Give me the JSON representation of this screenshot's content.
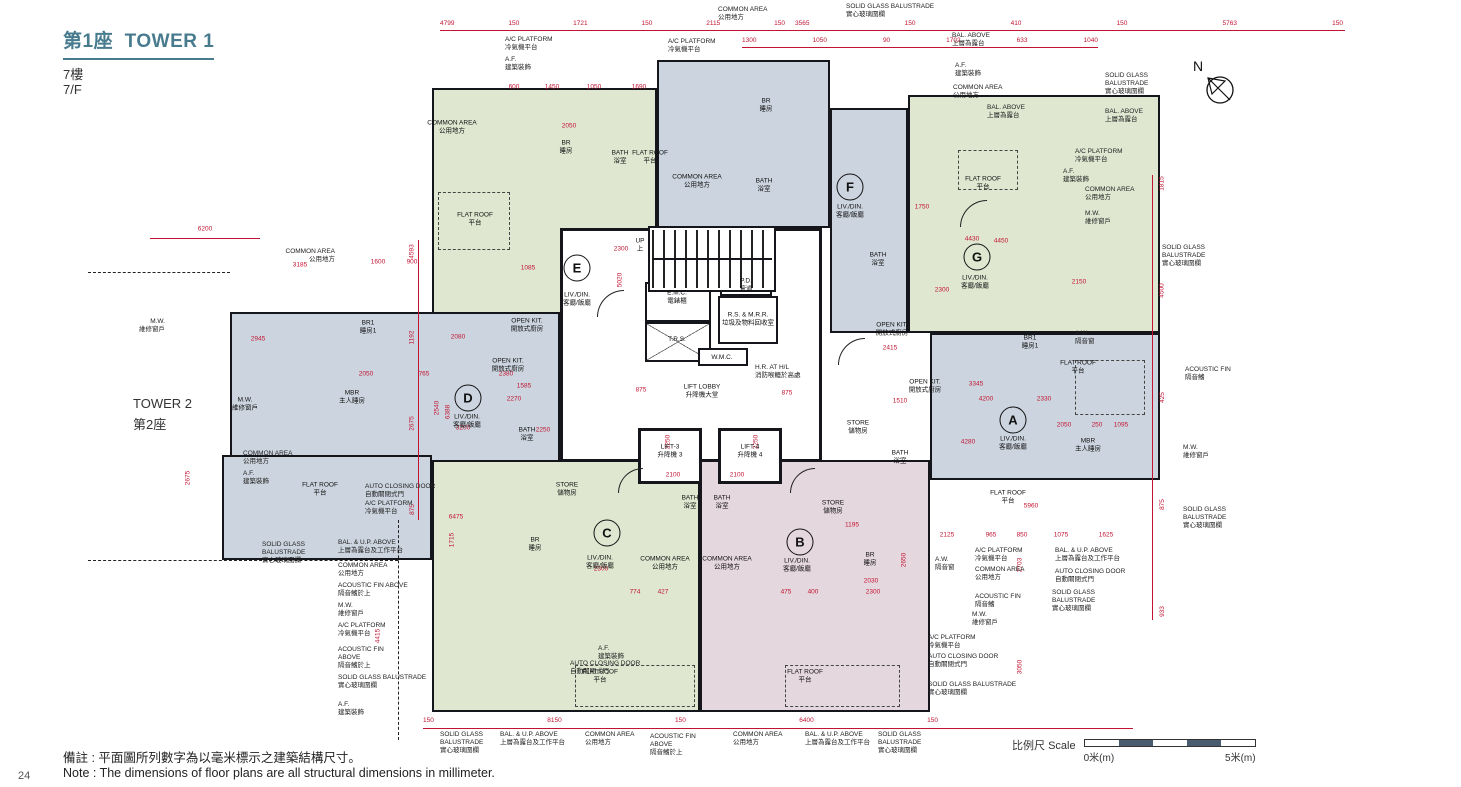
{
  "header": {
    "title_zh": "第1座",
    "title_en": "TOWER 1",
    "floor_zh": "7樓",
    "floor_en": "7/F"
  },
  "tower2": {
    "en": "TOWER 2",
    "zh": "第2座"
  },
  "compass": {
    "label": "N"
  },
  "page": {
    "number": "24"
  },
  "scale": {
    "zh": "比例尺",
    "en": "Scale",
    "from": "0米(m)",
    "to": "5米(m)"
  },
  "notes": {
    "zh": "備註 : 平面圖所列數字為以毫米標示之建築結構尺寸。",
    "en": "Note : The dimensions of floor plans are all structural dimensions in millimeter."
  },
  "units": [
    "A",
    "B",
    "C",
    "D",
    "E",
    "F",
    "G"
  ],
  "colors": {
    "dim_red": "#c21432",
    "zone_green": "#dfe7d1",
    "zone_blue": "#ccd5df",
    "zone_pink": "#e5d7de",
    "title_teal": "#477b8d",
    "scale_dark": "#4a5c70"
  },
  "labels": {
    "sgb": {
      "en": "SOLID GLASS BALUSTRADE",
      "zh": "實心玻璃圍欄"
    },
    "sgb2": {
      "en": "SOLID GLASS",
      "en2": "BALUSTRADE",
      "zh": "實心玻璃圍欄"
    },
    "balup": {
      "en": "BAL. & U.P. ABOVE",
      "zh": "上層為露台及工作平台"
    },
    "bal": {
      "en": "BAL. ABOVE",
      "zh": "上層為露台"
    },
    "ca": {
      "en": "COMMON AREA",
      "zh": "公用地方"
    },
    "afina": {
      "en": "ACOUSTIC FIN ABOVE",
      "zh": "隔音鰭於上"
    },
    "afin": {
      "en": "ACOUSTIC FIN",
      "zh": "隔音鰭"
    },
    "mw": {
      "en": "M.W.",
      "zh": "維修窗戶"
    },
    "aw": {
      "en": "A.W.",
      "zh": "隔音窗"
    },
    "acp": {
      "en": "A/C PLATFORM",
      "zh": "冷氣機平台"
    },
    "acd": {
      "en": "AUTO CLOSING DOOR",
      "zh": "自動關閉式門"
    },
    "af": {
      "en": "A.F.",
      "zh": "建築裝飾"
    },
    "fr": {
      "en": "FLAT ROOF",
      "zh": "平台"
    },
    "ok": {
      "en": "OPEN KIT.",
      "zh": "開放式廚房"
    },
    "bath": {
      "en": "BATH",
      "zh": "浴室"
    },
    "store": {
      "en": "STORE",
      "zh": "儲物房"
    },
    "br": {
      "en": "BR",
      "zh": "睡房"
    },
    "br1": {
      "en": "BR1",
      "zh": "睡房1"
    },
    "mbr": {
      "en": "MBR",
      "zh": "主人睡房"
    },
    "ld": {
      "en": "LIV./DIN.",
      "zh": "客廳/飯廳"
    },
    "lobby": {
      "en": "LIFT LOBBY",
      "zh": "升降機大堂"
    },
    "lift3": {
      "en": "LIFT-3",
      "zh": "升降機 3"
    },
    "lift4": {
      "en": "LIFT-4",
      "zh": "升降機 4"
    },
    "emc": {
      "en": "E.M.C.",
      "zh": "電錶櫃"
    },
    "pd": {
      "en": "P.D.",
      "zh": "管道"
    },
    "rs": {
      "en": "R.S. & M.R.R.",
      "zh": "垃圾及物料回收室"
    },
    "wmc": {
      "en": "W.M.C.",
      "zh": ""
    },
    "trs": {
      "en": "T.R.S.",
      "zh": ""
    },
    "hr": {
      "en": "H.R. AT H/L",
      "zh": "消防喉轆於高處"
    },
    "up": {
      "en": "UP",
      "zh": "上"
    }
  },
  "dims": {
    "top1": [
      "4799",
      "150",
      "1721",
      "150",
      "2115",
      "150"
    ],
    "top2": [
      "3565",
      "150",
      "410",
      "150",
      "5763",
      "150"
    ],
    "top3": [
      "1300",
      "1050",
      "90",
      "1702",
      "633",
      "1040"
    ],
    "bottom": [
      "150",
      "8150",
      "150",
      "6400",
      "150"
    ],
    "right": [
      "1815",
      "4500",
      "425",
      "875",
      "933"
    ],
    "left": [
      "4593",
      "1192",
      "2675",
      "875"
    ],
    "s": [
      "6200",
      "3185",
      "1600",
      "900",
      "2945",
      "2050",
      "765",
      "2380",
      "1585",
      "2270",
      "3200",
      "2250",
      "2080",
      "2300",
      "1085",
      "2050",
      "600",
      "1450",
      "1050",
      "1690",
      "875",
      "875",
      "2100",
      "2100",
      "2300",
      "774",
      "427",
      "475",
      "400",
      "2300",
      "2030",
      "4200",
      "3345",
      "2330",
      "2050",
      "250",
      "1095",
      "4450",
      "2300",
      "2150",
      "1750",
      "4430",
      "6475",
      "5960",
      "2125",
      "965",
      "850",
      "1075",
      "1625",
      "4280",
      "1510",
      "4415",
      "2703",
      "3050",
      "2650",
      "5020",
      "2250",
      "2250",
      "2540",
      "6388",
      "2675",
      "1195",
      "2415",
      "1715"
    ]
  }
}
